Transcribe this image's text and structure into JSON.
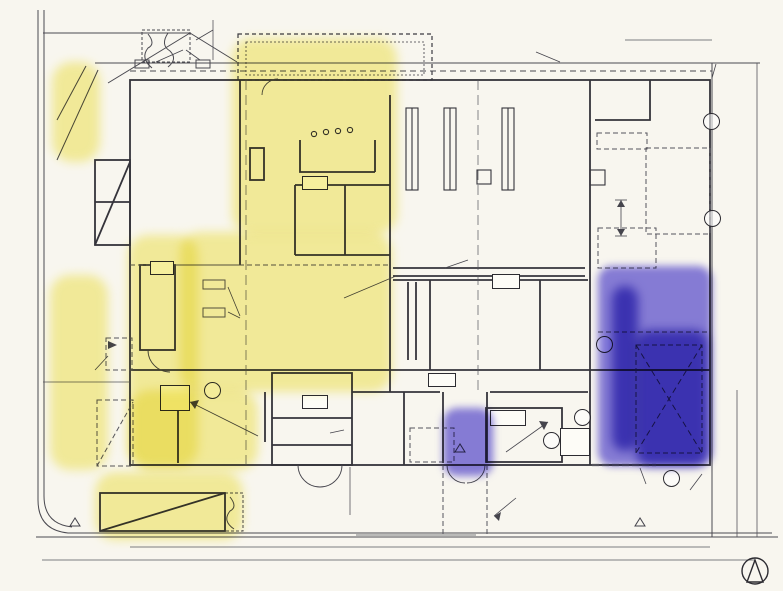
{
  "title": {
    "main": "1階平面図・配置図",
    "scale": "1/200"
  },
  "watermark": "教育的ウラ指導",
  "colors": {
    "highlight_yellow": "#f0e43c",
    "highlight_blue": "#5b4ed8",
    "ink": "#2a2830"
  },
  "rooms": {
    "exhibition": "企画展示\nスペース\n(112)",
    "cafe": "カフェ(56)",
    "register_counter": "レジ\nカウンター",
    "counter_kitchen": "カウンター\nキッチン",
    "staff_toilet": "スタッフ用\nトイレ",
    "nursing_room": "授乳\n室",
    "terrace": "屋外テラス席",
    "reading_seats": "閲覧席",
    "stacks": "書架",
    "collection_note": "蔵書数\n(1万冊)",
    "reading_space": "閲覧開架スペース (336)",
    "playroom": "プレイルーム\n(32)",
    "opac": "OPAC",
    "av_room": "試聴室\n(40)",
    "shoes_off": "下足",
    "shoes_on": "上足",
    "story_corner": "お話\nコーナー",
    "entrance_hall": "エントランス ホール",
    "windbreak": "風除室",
    "book_post": "ブック\nポスト",
    "service_counter": "サービス\nカウンター\n(28)",
    "library_workroom": "図書作業室\n(46)",
    "staff_lounge": "職員\n休憩室\n兼\n更衣室",
    "work_space": "作業スペース",
    "unpacking_space": "荷解き\n配本\nスペース\n(112)",
    "delivery_parking": "配本車\n駐車\nスペース",
    "corridor": "廊下",
    "toilet_w": "トイレ(女)",
    "toilet_m": "トイレ(男)",
    "wheelchair_toilet": "車椅子\n使用者\nトイレ",
    "pump_room_15": "ポンプ室(15)",
    "garbage": "ゴミ\n置場",
    "fire_pump": "消火ポンプ室(16)"
  },
  "annotations": {
    "setback": "最小後退距離",
    "setback_stack": "最小\n後退\n距離",
    "setback_right": "最小後退\n距離",
    "greenway": "歩道等ノ緑化経路",
    "bench": "ベンチ",
    "planting": "植栽",
    "fence": "フェンス",
    "wall_line": "外壁\nライン(1F)",
    "gl100": "GL+100",
    "gl100_stack": "GL\n+100",
    "gl0": "GL±0",
    "reference_note": "レファレンス\nサービスも\n兼用する",
    "opac_checkout": "OPAC・貸出手続",
    "service_note": "館内サービス\nの受付等の\n案内も兼用する",
    "bds": "BDS",
    "wheelchair_parking": "車椅子\n使用者用\n駐車場\n(2台)",
    "stall_count": "2",
    "main_entrance": "主出入口",
    "canopy": "上部庇",
    "site_path_left": "敷地内通路幅 2.0M",
    "bike_10": "10台",
    "bike_parking": "駐輪場\n(20台)",
    "bike_12": "12台",
    "site_path": "敷地内通路",
    "service_entrance": "通用口",
    "shutter": "シャッター"
  },
  "symbols": {
    "ps": "PS",
    "eps": "EPS",
    "ev": "EV",
    "fire_a": "特",
    "fire_b": "防",
    "ditto": "〃"
  },
  "dimensions": {
    "d1600": "1600",
    "d2000": "2000",
    "d3000": "3000",
    "d3600": "3600",
    "d4000": "4000",
    "d5000": "5000",
    "d6000": "6000",
    "d6000sp": "6 000",
    "d7000": "7000",
    "d8000": "8000",
    "d28000": "28000",
    "d40000": "40000"
  }
}
